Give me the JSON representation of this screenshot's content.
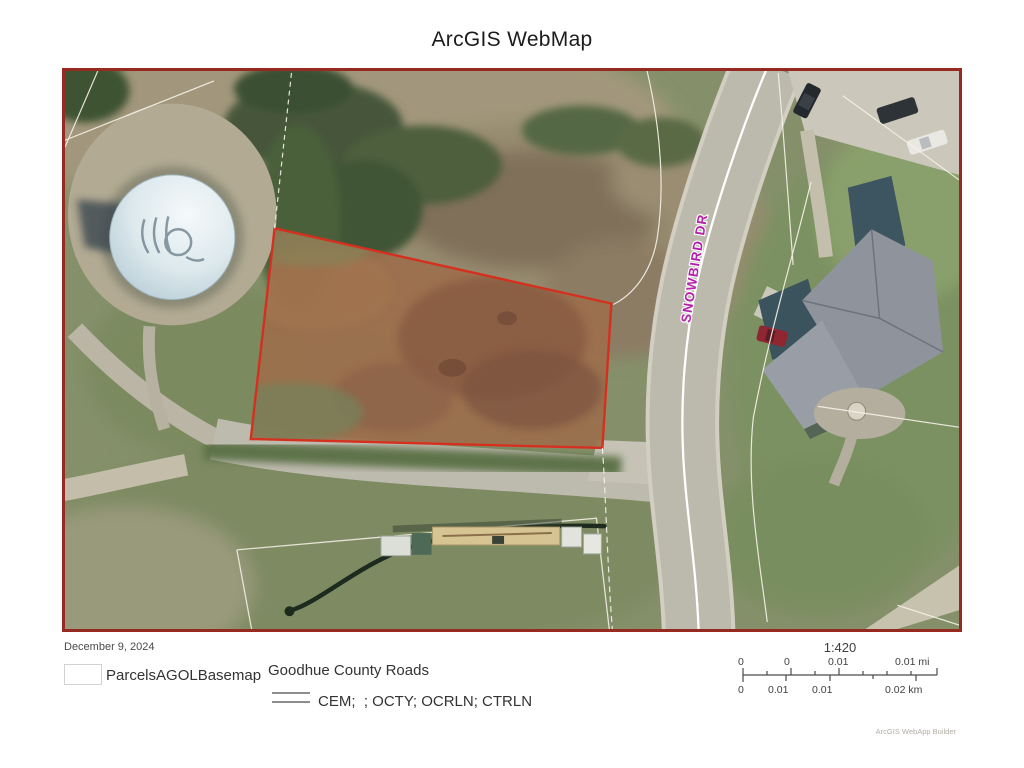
{
  "title": "ArcGIS WebMap",
  "map": {
    "road_label": "SNOWBIRD DR",
    "border_color": "#962a20",
    "parcel_outline_color": "#d5301f",
    "road_label_color": "#b517ad"
  },
  "footer": {
    "date": "December 9, 2024"
  },
  "legend": {
    "basemap_label": "ParcelsAGOLBasemap",
    "roads_group_label": "Goodhue County Roads",
    "roads_layer_label": "CEM;  ; OCTY; OCRLN; CTRLN"
  },
  "scalebar": {
    "ratio": "1:420",
    "mi_labels": [
      "0",
      "0",
      "0.01",
      "0.01 mi"
    ],
    "km_labels": [
      "0",
      "0.01",
      "0.01",
      "0.02 km"
    ]
  },
  "attribution": "ArcGIS WebApp Builder"
}
